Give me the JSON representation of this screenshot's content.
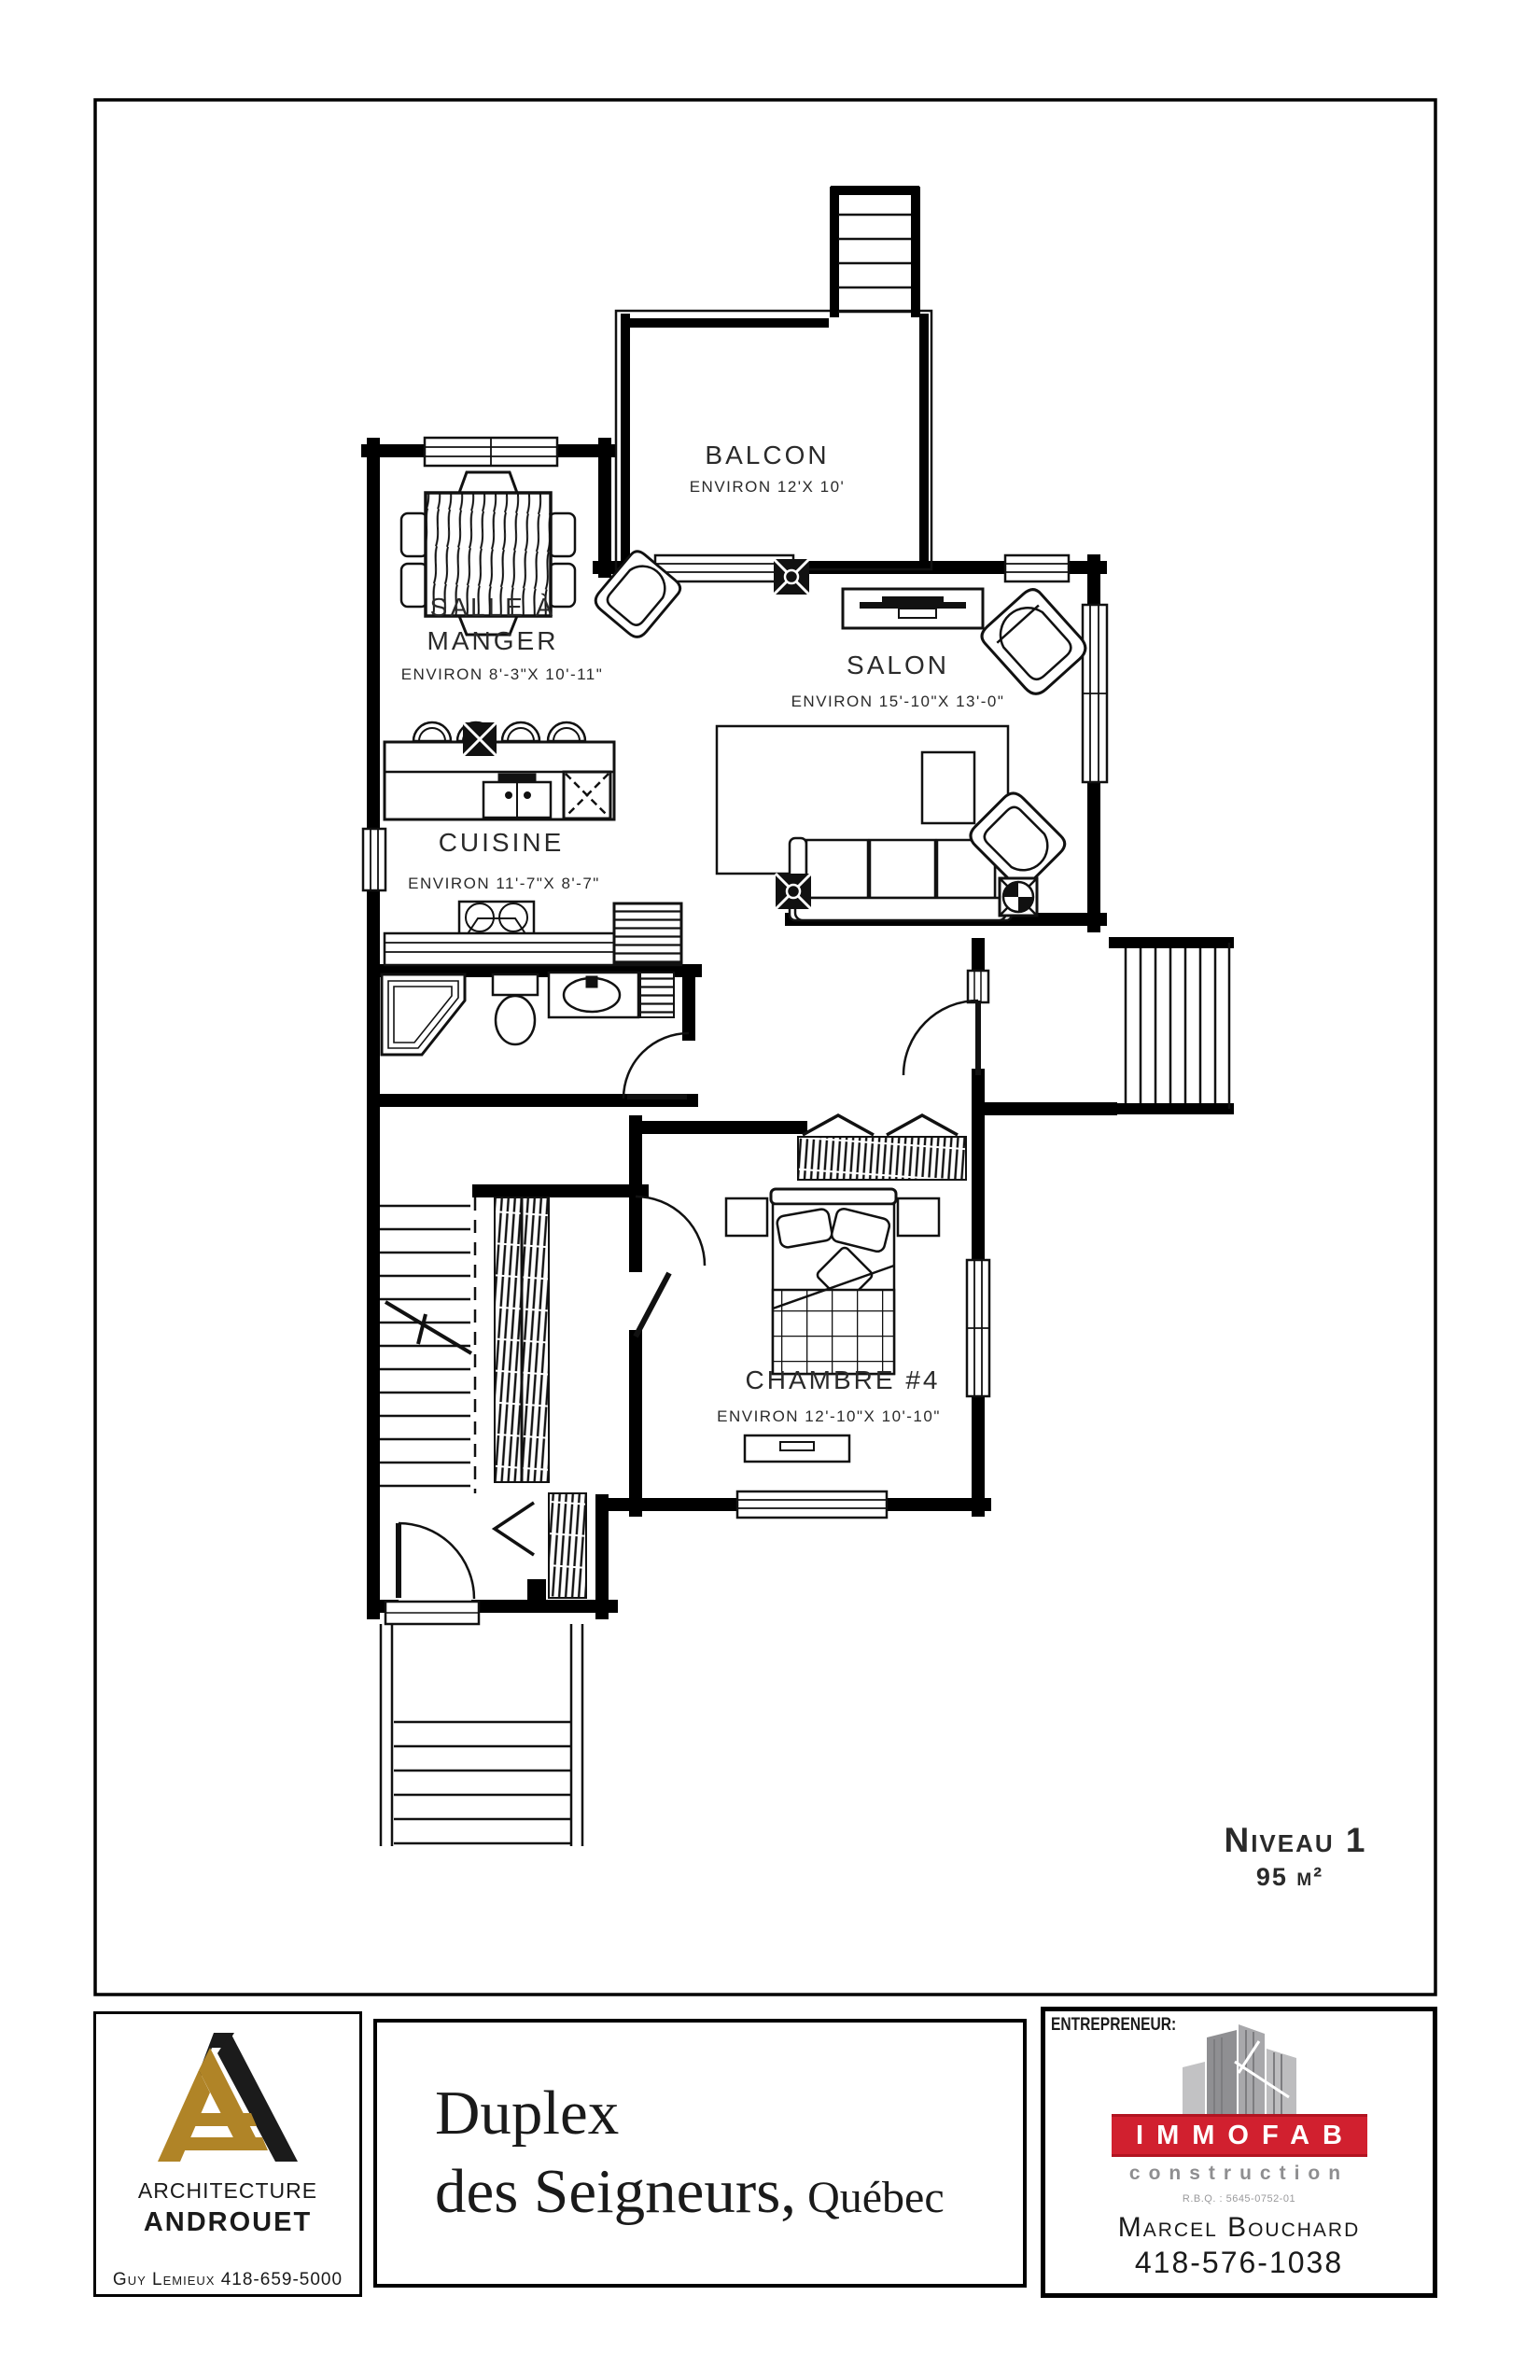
{
  "plan": {
    "level_label": "Niveau 1",
    "area_label": "95 m²",
    "rooms": {
      "balcon": {
        "name": "BALCON",
        "dims": "ENVIRON 12'X 10'"
      },
      "salle_a_manger": {
        "name_line1": "SALLE À",
        "name_line2": "MANGER",
        "dims": "ENVIRON 8'-3\"X 10'-11\""
      },
      "salon": {
        "name": "SALON",
        "dims": "ENVIRON 15'-10\"X 13'-0\""
      },
      "cuisine": {
        "name": "CUISINE",
        "dims": "ENVIRON 11'-7\"X 8'-7\""
      },
      "chambre4": {
        "name": "CHAMBRE #4",
        "dims": "ENVIRON 12'-10\"X 10'-10\""
      }
    }
  },
  "title_block": {
    "architect": {
      "line1": "ARCHITECTURE",
      "line2": "ANDROUET",
      "contact": "Guy Lemieux 418-659-5000"
    },
    "project": {
      "line1": "Duplex",
      "line2": "des Seigneurs,",
      "line2_suffix": " Québec"
    },
    "contractor": {
      "label": "ENTREPRENEUR:",
      "logo_text": "IMMOFAB",
      "logo_sub": "construction",
      "rbq": "R.B.Q. : 5645-0752-01",
      "name": "Marcel Bouchard",
      "phone": "418-576-1038"
    }
  },
  "colors": {
    "architect_gold": "#b08427",
    "contractor_red": "#d1202f",
    "building_gray": "#9a9a9c",
    "line_black": "#111111"
  }
}
